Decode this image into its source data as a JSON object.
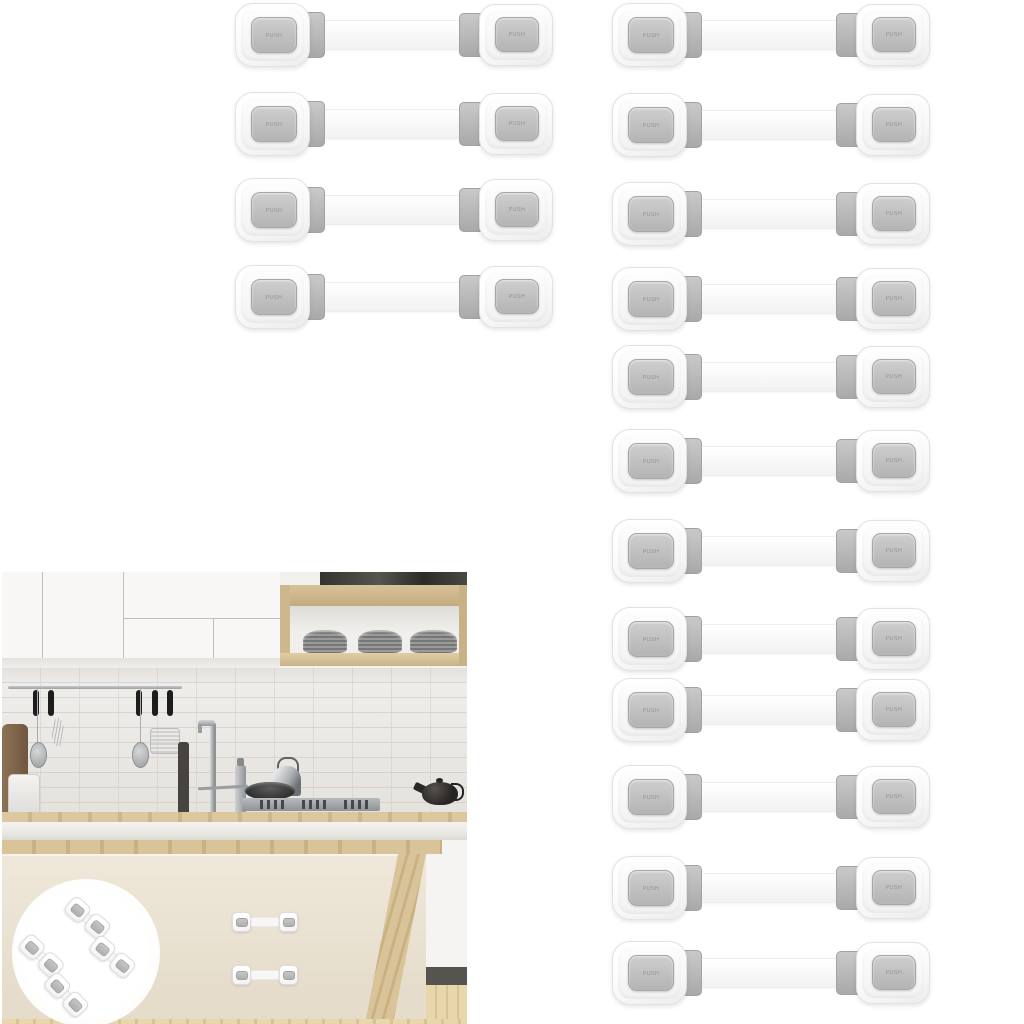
{
  "image": {
    "kind": "product-photo",
    "background": "#ffffff",
    "subject": "child-safety-strap-locks"
  },
  "lock_unit": {
    "button_label": "PUSH",
    "colors": {
      "body": "#fbfbfb",
      "body_edge": "#e2e2e2",
      "button": "#c0c0c0",
      "button_text": "#8b8b8b",
      "connector": "#b7b7b7",
      "strap": "#f7f7f7"
    }
  },
  "lock_groups": {
    "top_left": {
      "count": 4,
      "x": 235,
      "rows_y": [
        2,
        91,
        177,
        264
      ]
    },
    "right_column": {
      "count": 12,
      "x": 612,
      "rows_y": [
        2,
        92,
        181,
        266,
        344,
        428,
        518,
        606,
        677,
        764,
        855,
        940
      ]
    }
  },
  "kitchen_photo": {
    "installed_locks": [
      {
        "x": 230,
        "y": 339
      },
      {
        "x": 230,
        "y": 392
      }
    ],
    "inset": {
      "locks_count": 4,
      "locks": [
        {
          "cx": 85,
          "cy": 345,
          "rot": 40
        },
        {
          "cx": 39,
          "cy": 383,
          "rot": 43
        },
        {
          "cx": 110,
          "cy": 384,
          "rot": 40
        },
        {
          "cx": 64,
          "cy": 422,
          "rot": 46
        }
      ]
    },
    "plate_stacks": 3,
    "drawer_handles": 4,
    "utensil_handles": 5,
    "colors": {
      "wood": "#d0ba90",
      "tile": "#efedea",
      "grout": "#dcd9d4",
      "cabinet_cream": "#ebe3d5",
      "cabinet_white": "#f8f7f5",
      "drawer_handle": "#1e1e1e",
      "teapot": "#2e2c2b",
      "floor": "#e4d2a9"
    }
  }
}
